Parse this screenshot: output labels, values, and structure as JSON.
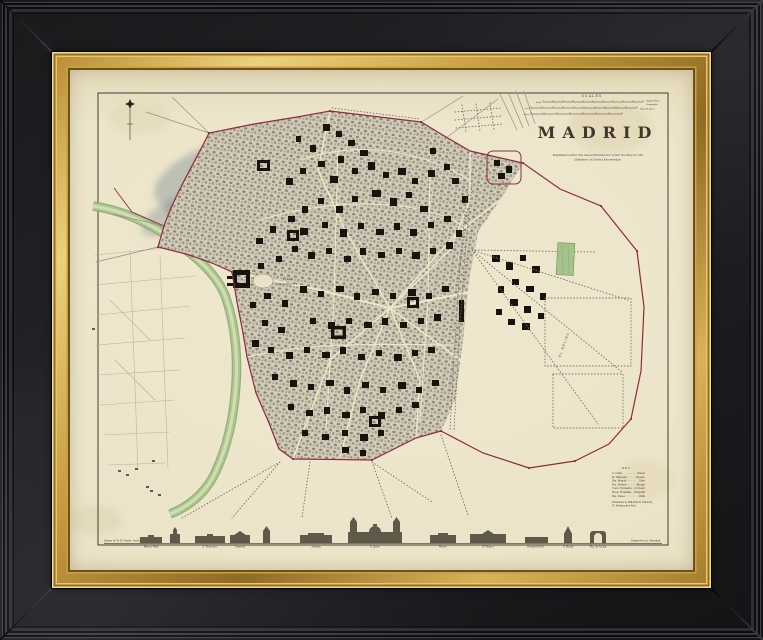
{
  "palette": {
    "frame_black": "#1d1d20",
    "frame_gold": "#c79b3b",
    "paper": "#ebe3c8",
    "river_green": "#a9c28e",
    "boundary_red": "#8c2b40",
    "ink": "#26211a"
  },
  "map": {
    "title": "MADRID",
    "imprint": [
      "Published under the Superintendence of the Society for the",
      "Diffusion of Useful Knowledge."
    ],
    "scales": {
      "title": "SCALES",
      "bars": [
        "Yards",
        "Feet",
        "Varas"
      ],
      "notes": [
        "English Miles",
        "Spanish Varas",
        "Geographic"
      ]
    },
    "key": {
      "title": "KEY.",
      "rows": [
        {
          "a": "C.  Calle",
          "b": "Street"
        },
        {
          "a": "Pl.  Plazuela",
          "b": "Square"
        },
        {
          "a": "Pta.  Puerta",
          "b": "Gate"
        },
        {
          "a": "Pte.  Puente",
          "b": "Bridge"
        },
        {
          "a": "Conv.  Convento",
          "b": "Convent"
        },
        {
          "a": "Hosp.  Hospital",
          "b": "Hospital"
        },
        {
          "a": "Pas.  Paseo",
          "b": "Walk"
        }
      ],
      "note": [
        "Published by Baldwin & Cradock,",
        "47 Paternoster Row."
      ]
    },
    "credits": {
      "left": "Drawn by W. B. Clarke, Archt.",
      "right": "Engraved by J. Henshall."
    },
    "labels": {
      "plaza": "PLAZA",
      "plaza2": "DE ORIENTE",
      "retiro": "EL RETIRO"
    },
    "skyline": {
      "captions": [
        "Palacio Real",
        "S. Francisco",
        "Armeria",
        "Aduana",
        "S. Isidro",
        "Museo",
        "Pl. Mayor",
        "Hospital Genl.",
        "S. Maria",
        "Pta. de Alcala"
      ]
    }
  }
}
